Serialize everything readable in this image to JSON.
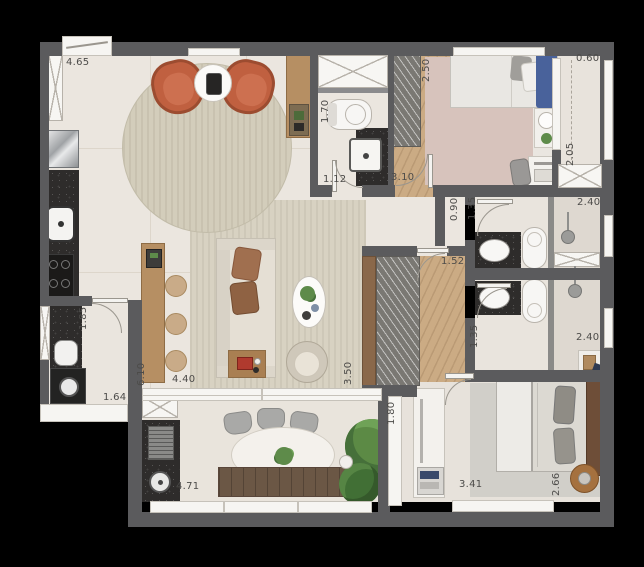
{
  "plan": {
    "unit": "m",
    "dimensions": [
      {
        "id": "entry-kitchen-length",
        "value": "4.65"
      },
      {
        "id": "service-balcony-width",
        "value": "0.60"
      },
      {
        "id": "bedroom1-depth",
        "value": "2.50"
      },
      {
        "id": "wc-depth",
        "value": "1.70"
      },
      {
        "id": "wc-width",
        "value": "1.12"
      },
      {
        "id": "bedroom1-width",
        "value": "3.10"
      },
      {
        "id": "service-balcony-length",
        "value": "2.05"
      },
      {
        "id": "hall-width",
        "value": "0.90"
      },
      {
        "id": "bathroom1-depth",
        "value": "1.35"
      },
      {
        "id": "bathroom1-width",
        "value": "2.40"
      },
      {
        "id": "hall-length",
        "value": "1.52"
      },
      {
        "id": "laundry-depth",
        "value": "1.85"
      },
      {
        "id": "living-length",
        "value": "6.10"
      },
      {
        "id": "living-width",
        "value": "4.40"
      },
      {
        "id": "living-depth",
        "value": "3.50"
      },
      {
        "id": "bathroom2-depth",
        "value": "1.35"
      },
      {
        "id": "bathroom2-width",
        "value": "2.40"
      },
      {
        "id": "laundry-width",
        "value": "1.64"
      },
      {
        "id": "terrace-depth",
        "value": "1.80"
      },
      {
        "id": "terrace-width",
        "value": "4.71"
      },
      {
        "id": "bedroom2-width",
        "value": "3.41"
      },
      {
        "id": "bedroom2-depth",
        "value": "2.66"
      }
    ],
    "palette": {
      "background": "#000000",
      "walls": "#5b5b5d",
      "floor": "#ebe6df",
      "rug": "#d8d2c2",
      "wood_floor": "#cbab84",
      "granite": "#2e2c2b",
      "accent_armchair": "#c06040",
      "plants": "#5c8a45",
      "bed_blue": "#49629b"
    }
  }
}
